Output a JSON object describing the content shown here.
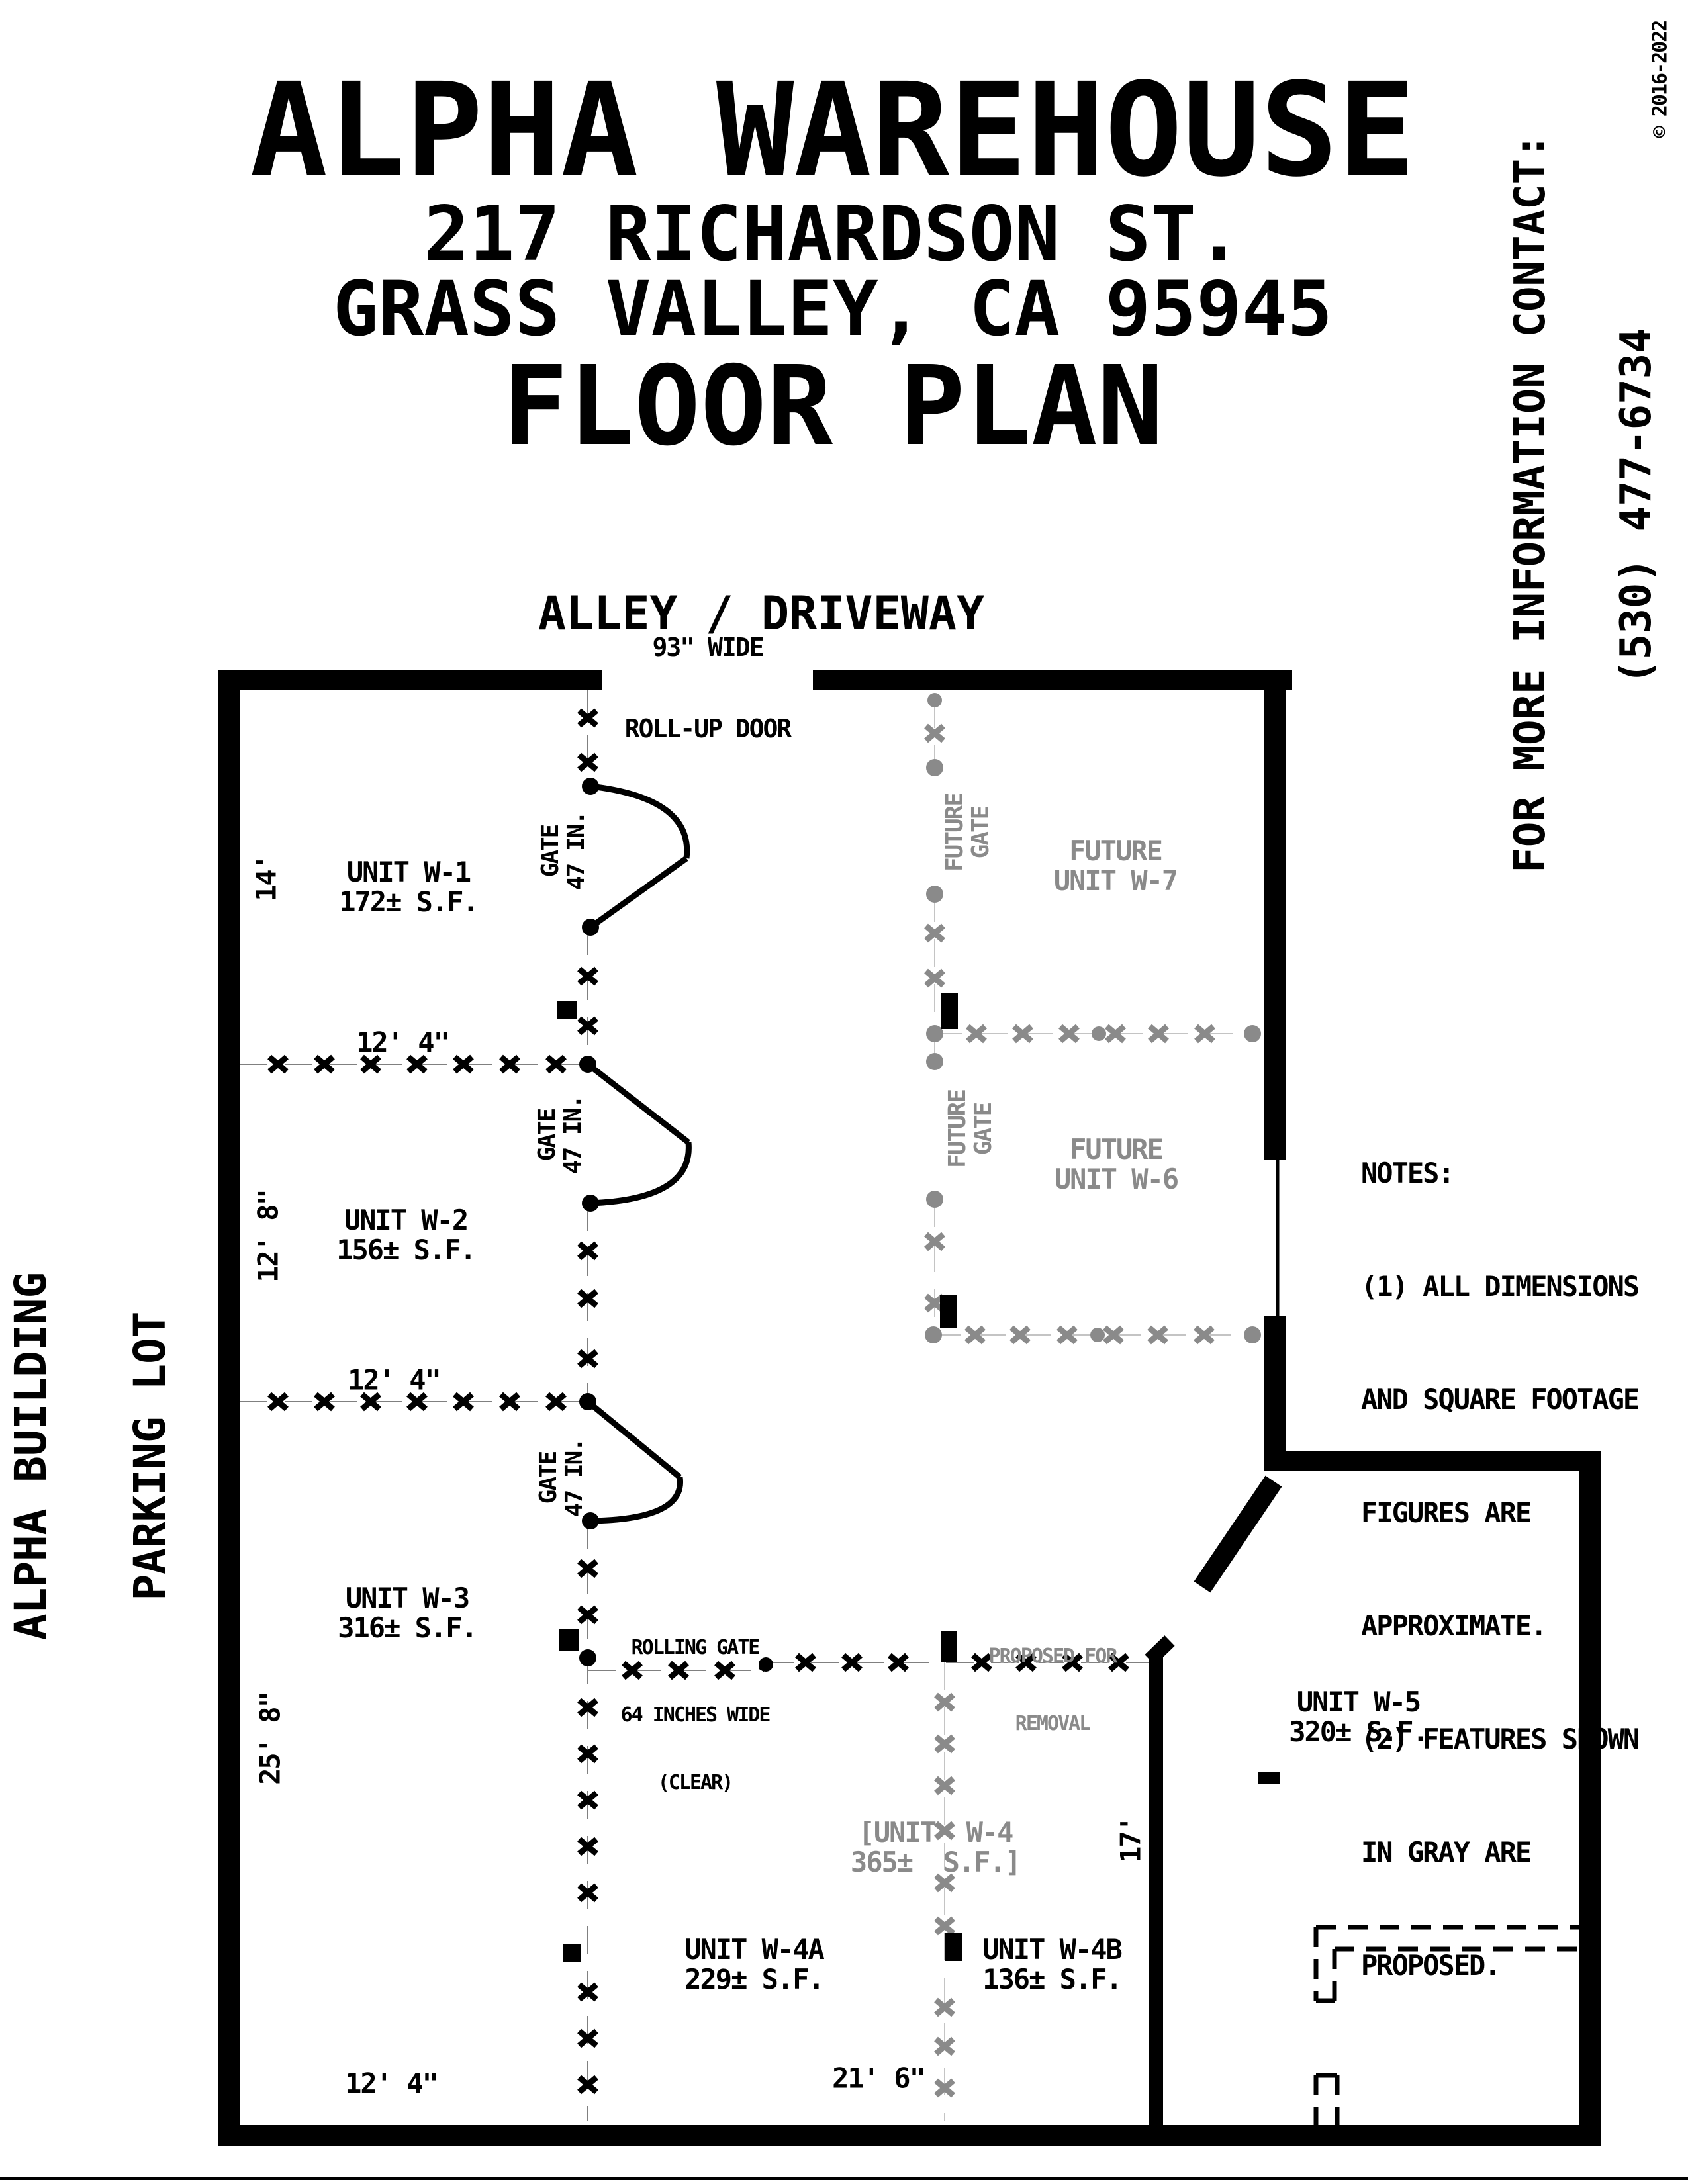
{
  "title": {
    "line1": "ALPHA WAREHOUSE",
    "line2": "217 RICHARDSON ST.",
    "line3": "GRASS VALLEY, CA 95945",
    "line4": "FLOOR PLAN"
  },
  "sidebar": {
    "contact": "FOR MORE INFORMATION CONTACT:",
    "phone": "(530) 477-6734",
    "copyright": "© 2016-2022"
  },
  "alley_label": "ALLEY / DRIVEWAY",
  "rollup_door": {
    "line1": "93\" WIDE",
    "line2": "ROLL-UP DOOR"
  },
  "parking": {
    "line1": "ALPHA BUILDING",
    "line2": "PARKING LOT"
  },
  "units": {
    "w1": {
      "name": "UNIT W-1",
      "area": "172± S.F."
    },
    "w2": {
      "name": "UNIT W-2",
      "area": "156± S.F."
    },
    "w3": {
      "name": "UNIT W-3",
      "area": "316± S.F."
    },
    "w4": {
      "name": "[UNIT  W-4",
      "area": "365±  S.F.]"
    },
    "w4a": {
      "name": "UNIT W-4A",
      "area": "229± S.F."
    },
    "w4b": {
      "name": "UNIT W-4B",
      "area": "136± S.F."
    },
    "w5": {
      "name": "UNIT W-5",
      "area": "320± S.F."
    },
    "w6": {
      "line1": "FUTURE",
      "line2": "UNIT W-6"
    },
    "w7": {
      "line1": "FUTURE",
      "line2": "UNIT W-7"
    }
  },
  "gates": {
    "swing": {
      "line1": "GATE",
      "line2": "47 IN."
    },
    "future": {
      "line1": "FUTURE",
      "line2": "GATE"
    },
    "rolling": {
      "line1": "ROLLING GATE",
      "line2": "64 INCHES WIDE",
      "line3": "(CLEAR)"
    }
  },
  "removal": {
    "line1": "PROPOSED FOR",
    "line2": "REMOVAL"
  },
  "dimensions": {
    "d14": "14'",
    "d12_8": "12' 8\"",
    "d25_8": "25' 8\"",
    "d12_4": "12' 4\"",
    "d17": "17'",
    "d21_6": "21' 6\""
  },
  "notes": {
    "lines": [
      "NOTES:",
      "(1) ALL DIMENSIONS",
      "AND SQUARE FOOTAGE",
      "FIGURES ARE",
      "APPROXIMATE.",
      "(2) FEATURES SHOWN",
      "IN GRAY ARE",
      "PROPOSED."
    ]
  },
  "colors": {
    "ink": "#000000",
    "proposed": "#8a8a8a"
  }
}
